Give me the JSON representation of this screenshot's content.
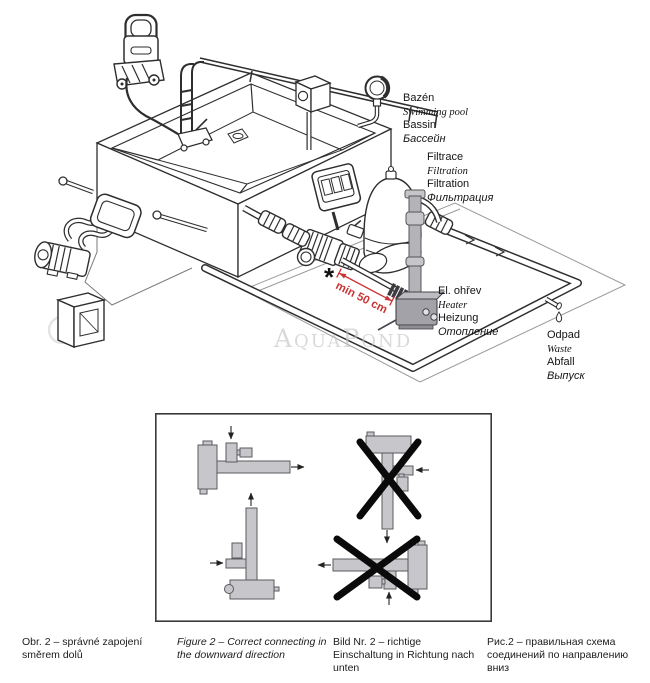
{
  "page": {
    "background": "#ffffff"
  },
  "watermark": {
    "text": "AquaPond"
  },
  "annotation": {
    "asterisk": "*",
    "min_distance": "min 50 cm"
  },
  "labels": {
    "pool": {
      "cs": "Bazén",
      "en": "Swimming pool",
      "de": "Bassin",
      "ru": "Бассейн"
    },
    "filtration": {
      "cs": "Filtrace",
      "en": "Filtration",
      "de": "Filtration",
      "ru": "Фильтрация"
    },
    "heater": {
      "cs": "El. ohřev",
      "en": "Heater",
      "de": "Heizung",
      "ru": "Отопление"
    },
    "waste": {
      "cs": "Odpad",
      "en": "Waste",
      "de": "Abfall",
      "ru": "Выпуск"
    }
  },
  "captions": [
    {
      "lang": "cs",
      "text": "Obr. 2 – správné zapojení směrem dolů"
    },
    {
      "lang": "en",
      "text": "Figure 2 – Correct connecting in the downward direction"
    },
    {
      "lang": "de",
      "text": "Bild Nr. 2 – richtige Einschaltung in Richtung nach unten"
    },
    {
      "lang": "ru",
      "text": "Рис.2 – правильная схема соединений по направлению вниз"
    }
  ],
  "colors": {
    "line": "#2e2e2e",
    "annotation_red": "#c93434",
    "schematic_fill": "#c7c7cb",
    "schematic_stroke": "#5a5a5f",
    "heater_gray": "#a2a2a8",
    "watermark_gray": "#c2c2c2"
  }
}
